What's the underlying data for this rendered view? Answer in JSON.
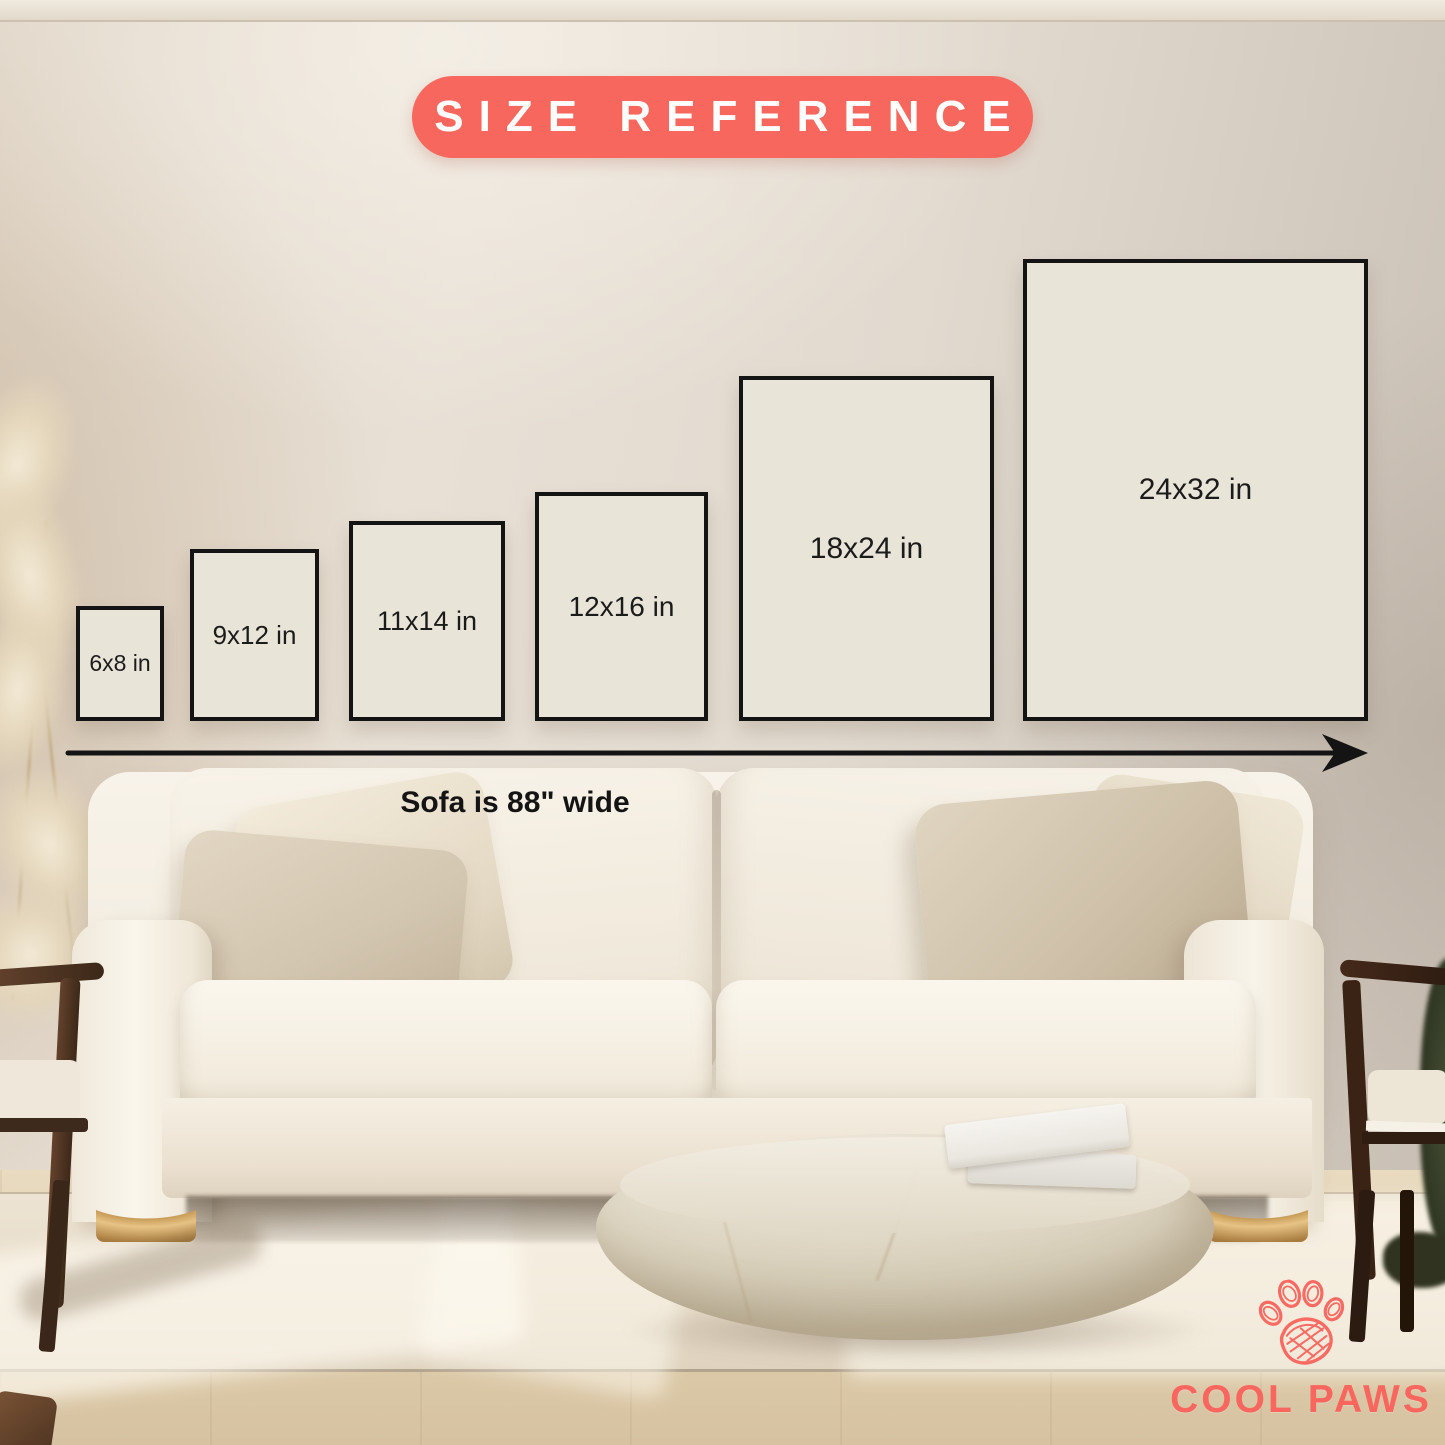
{
  "header": {
    "badge_label": "SIZE REFERENCE"
  },
  "size_chart": {
    "type": "size-comparison",
    "unit": "in",
    "items": [
      {
        "label": "6x8 in",
        "width_in": 6,
        "height_in": 8
      },
      {
        "label": "9x12 in",
        "width_in": 9,
        "height_in": 12
      },
      {
        "label": "11x14 in",
        "width_in": 11,
        "height_in": 14
      },
      {
        "label": "12x16 in",
        "width_in": 12,
        "height_in": 16
      },
      {
        "label": "18x24 in",
        "width_in": 18,
        "height_in": 24
      },
      {
        "label": "24x32 in",
        "width_in": 24,
        "height_in": 32
      }
    ],
    "sofa_note": "Sofa is 88\" wide",
    "axis": "horizontal-arrow-right"
  },
  "brand": {
    "name": "COOL PAWS",
    "icon": "paw-icon",
    "color": "#F8665E"
  },
  "colors": {
    "accent_coral": "#F8675E",
    "frame_fill": "#E8E4D8",
    "frame_border": "#141414",
    "label_text": "#1B1B1B",
    "wall_beige": "#E2DACF"
  },
  "scene": {
    "description": "beige living room with cream sofa, two dark wood chairs, pampas grass, stone coffee table with two books, light rug on wood floor"
  }
}
